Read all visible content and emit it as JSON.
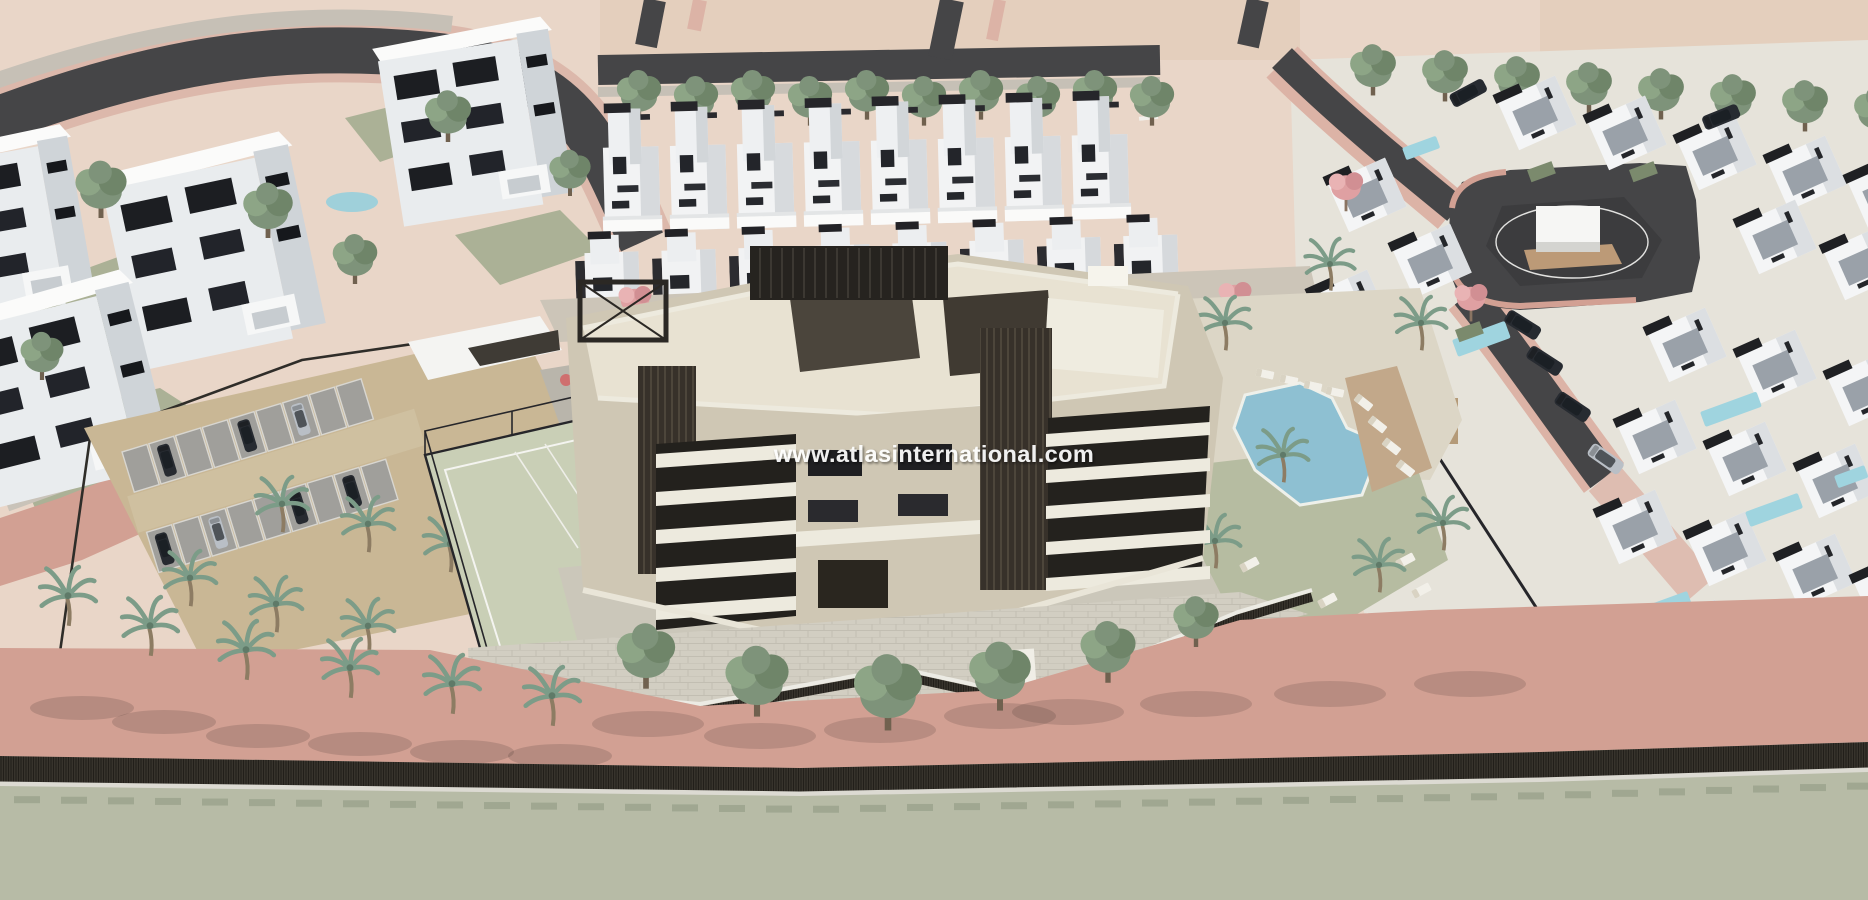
{
  "watermark": {
    "text": "www.atlasinternational.com"
  },
  "palette": {
    "sand": "#e9d6c8",
    "sand2": "#e4cfbd",
    "pink": "#d2a093",
    "pinksoft": "#dcb3a6",
    "roaddark": "#454547",
    "roadgreen": "#b7bba6",
    "walk": "#c6c0b6",
    "hedge": "#37332c",
    "lawn": "#abb196",
    "lawn2": "#b6bca1",
    "gravel": "#cfc0a0",
    "paveL": "#dcd6c6",
    "paveG": "#cbc7ba",
    "white": "#f3f3f2",
    "shade": "#d6d9dc",
    "darkroof": "#232326",
    "cream": "#cfc7b4",
    "cream2": "#e8e2d2",
    "brown": "#37312a",
    "slab": "#edeade",
    "win": "#1f1f22",
    "pool": "#8ec0d2",
    "pool2": "#9fd4df",
    "deck": "#c2a88a",
    "court": "#c9cfb6",
    "tree1": "#7e937a",
    "tree2": "#6f8569",
    "tree3": "#8da586",
    "palm": "#7c9c88",
    "pinktree": "#dfa0a2",
    "carDark": "#272b31",
    "carSilver": "#b9bfc6",
    "stall": "#a09f9b",
    "trunk": "#70614f"
  }
}
